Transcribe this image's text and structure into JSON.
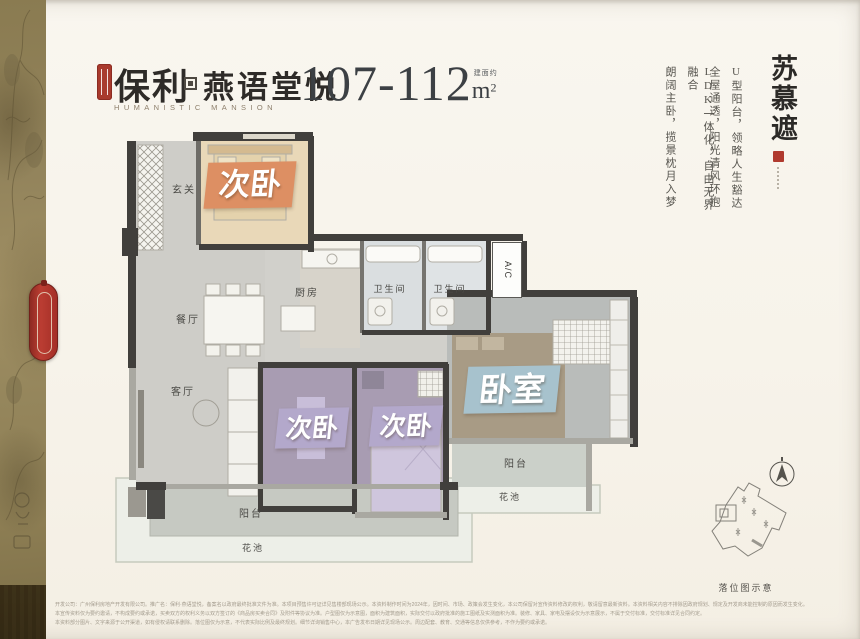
{
  "header": {
    "logo": {
      "primary": "保利",
      "secondary": "燕语堂悦",
      "english": "HUMANISTIC MANSION"
    },
    "area": {
      "range": "107-112",
      "prefix": "建面约",
      "unit": "m",
      "sup": "2"
    }
  },
  "right_panel": {
    "title": "苏慕遮",
    "lines": [
      "U型阳台，领略人生豁达",
      "全屋通透，阳光清风环抱",
      "LDK一体化，自由无界融合",
      "朗阔主卧，揽景枕月入梦"
    ]
  },
  "floorplan": {
    "entrance": "玄关",
    "bedroom_top": "次卧",
    "dining": "餐厅",
    "kitchen": "厨房",
    "bath_1": "卫生间",
    "bath_2": "卫生间",
    "ac": "A/C",
    "living": "客厅",
    "bedroom_left": "次卧",
    "bedroom_mid": "次卧",
    "master": "卧室",
    "balcony_right": "阳台",
    "flowerbed_right": "花池",
    "balcony_bottom": "阳台",
    "flowerbed_bottom": "花池"
  },
  "siteplan": {
    "caption": "落位图示意"
  },
  "disclaimer": {
    "line1": "开发公司：广州保利房地产开发有限公司。推广名：保利·燕语堂悦，备案名以政府最终批准文件为准。本项目预售许可证详见售楼部现场公示。本资料制作时间为2024年，因时间、市场、政策会发生变化，本公司保留对宣传资料修改的权利，敬请留意最新资料。本资料相关内容不排除因政府规划、规定及开发商未能控制的原因而发生变化。",
    "line2": "本宣传资料仅为要约邀请，不构成要约或承诺，买卖双方的权利义务以双方签订的《商品房买卖合同》及附件等协议为准。户型图仅为示意图，面积为建筑面积，实际交付以政府批准的施工图纸及实测面积为准。装修、家具、家电及摆设仅为示意展示，不属于交付标准，交付标准详见合同约定。",
    "line3": "本资料部分图片、文字来源于公开渠道，如有侵权请联系删除。落位图仅为示意，不代表实际比例及最终规划。细节详询销售中心，本广告发布日期详见现场公示。周边配套、教育、交通等信息仅供参考，不作为要约或承诺。"
  },
  "colors": {
    "accent_red": "#b03a2e",
    "badge_orange": "#dd8f63",
    "badge_purple": "#b3a8cb",
    "badge_blue": "#a7c2cd",
    "background": "#f7f3ea"
  }
}
